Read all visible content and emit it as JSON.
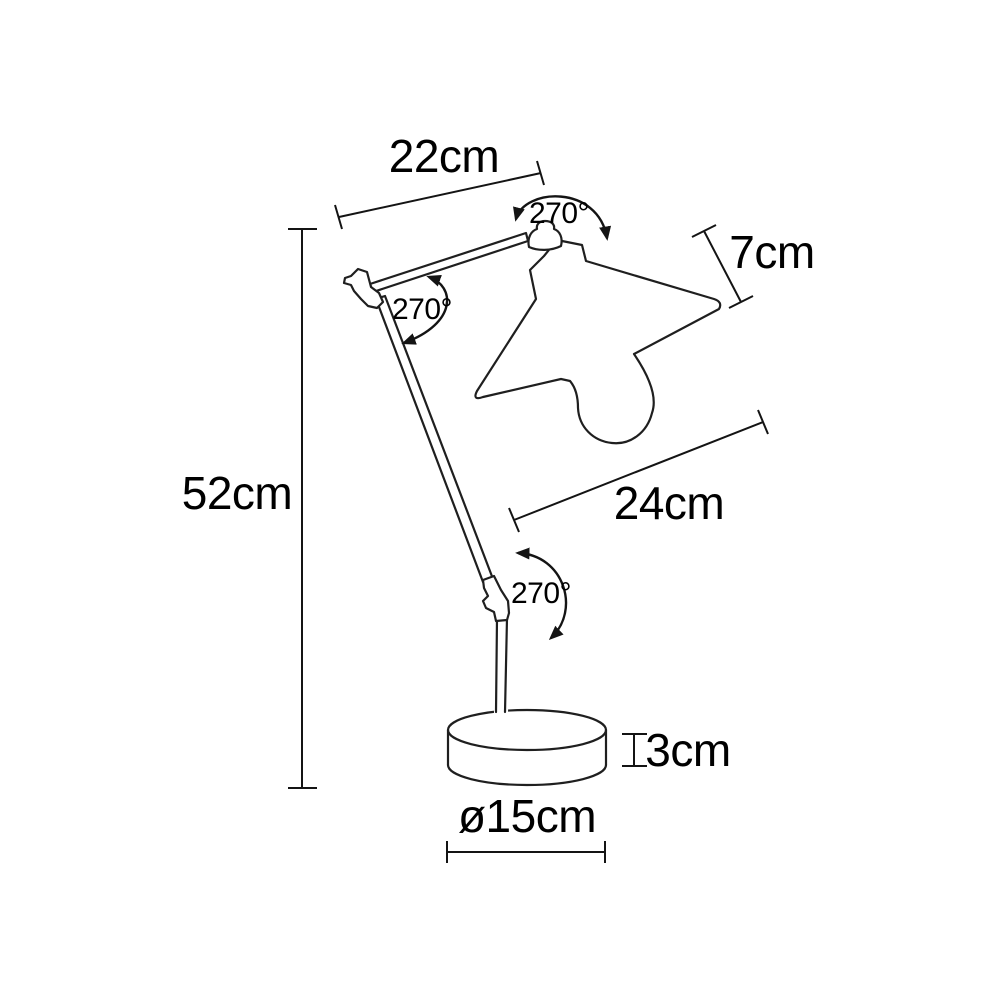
{
  "page": {
    "background": "#ffffff"
  },
  "drawing": {
    "subject": "Articulated table lamp technical dimension drawing",
    "line_color": "#1f1f1f",
    "text_color": "#000000",
    "parts": [
      "upper arm",
      "lower arm",
      "elbow joint",
      "head joint",
      "lamp shade",
      "bulb",
      "knee joint",
      "stem",
      "round base"
    ]
  },
  "dimensions": {
    "upper_arm_length": {
      "label": "22cm",
      "value": 22,
      "unit": "cm"
    },
    "head_rotation": {
      "label": "270°",
      "value": 270,
      "unit": "degrees"
    },
    "shade_height": {
      "label": "7cm",
      "value": 7,
      "unit": "cm"
    },
    "elbow_rotation": {
      "label": "270°",
      "value": 270,
      "unit": "degrees"
    },
    "total_height": {
      "label": "52cm",
      "value": 52,
      "unit": "cm"
    },
    "lower_arm_length": {
      "label": "24cm",
      "value": 24,
      "unit": "cm"
    },
    "base_joint_rotation": {
      "label": "270°",
      "value": 270,
      "unit": "degrees"
    },
    "base_height": {
      "label": "3cm",
      "value": 3,
      "unit": "cm"
    },
    "base_diameter": {
      "label": "ø15cm",
      "value": 15,
      "unit": "cm"
    }
  }
}
